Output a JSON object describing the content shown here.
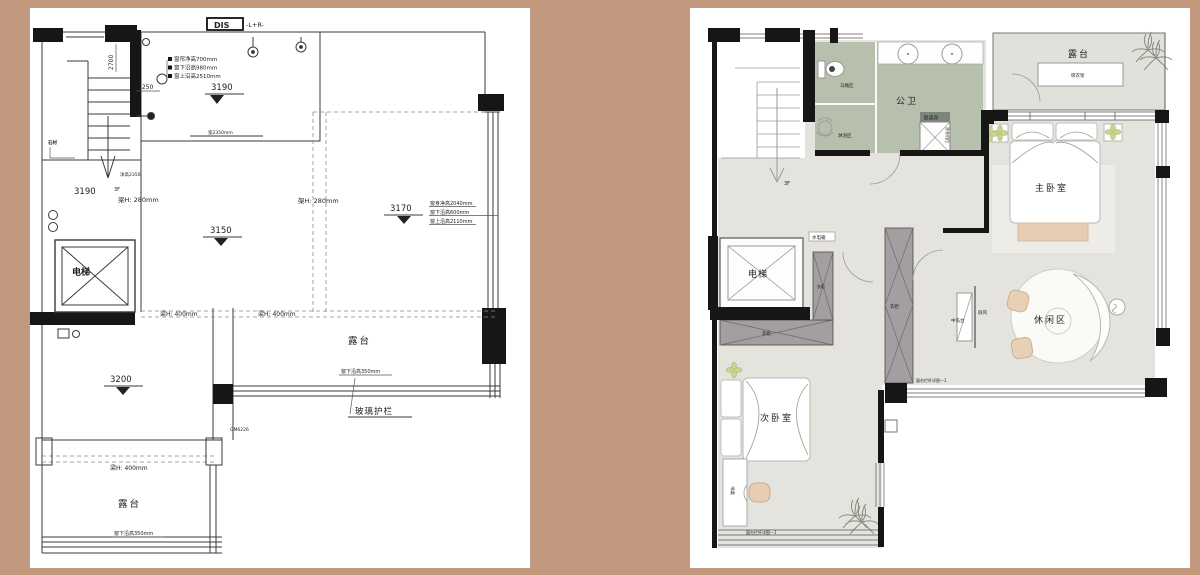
{
  "colors": {
    "page_bg": "#c2997f",
    "wall": "#1a1a1a",
    "floor": "#e4e3de",
    "bath_green": "#b7bfad",
    "wardrobe_gray": "#a39ea0",
    "tan_accent": "#e6cdb3",
    "plant_green": "#c9d48f"
  },
  "left_plan": {
    "dis_label": "DIS",
    "dis_suffix": "-L+R-",
    "dim_2700": "2700",
    "dim_1250": "1250",
    "ann_top": [
      "窗帘净高700mm",
      "窗下沿高980mm",
      "窗上沿高2510mm"
    ],
    "win_note": "宽2350mm",
    "stone": "石材",
    "stair_floor": "3F",
    "stair_note": "净高2350",
    "elev_hall": "3190",
    "beam280": "梁H: 280mm",
    "elev_room": "3190",
    "elev_mid": "3150",
    "elev_right": "3170",
    "rack280": "架H: 280mm",
    "ann_right": [
      "窗身净高2040mm",
      "窗下沿高600mm",
      "窗上沿高2110mm"
    ],
    "beam400_a": "梁H: 400mm",
    "beam400_b": "梁H: 400mm",
    "beam400_c": "梁H: 400mm",
    "elevator": "电梯",
    "elev_low": "3200",
    "terrace_a": "露台",
    "sill350_a": "窗下沿高350mm",
    "glass_rail": "玻璃护栏",
    "code": "GM6226",
    "terrace_b": "露台",
    "sill350_b": "窗下沿高350mm"
  },
  "right_plan": {
    "stair_floor": "3F",
    "bath": "公卫",
    "toilet_zone": "马桶区",
    "shower_zone": "淋浴区",
    "shaft": "管道井",
    "washer": "洗衣机位",
    "utility": "水电箱",
    "terrace": "露台",
    "drying_rack": "晾衣架",
    "master": "主卧室",
    "leisure": "休闲区",
    "screen": "屏风",
    "island": "中岛台",
    "elevator": "电梯",
    "wardrobe_a": "衣柜",
    "wardrobe_b": "衣柜",
    "wardrobe_c": "衣柜",
    "bedroom2": "次卧室",
    "desk": "书桌",
    "note_a": "窗台栏杆详图—1",
    "note_b": "窗台栏杆详图—1"
  }
}
